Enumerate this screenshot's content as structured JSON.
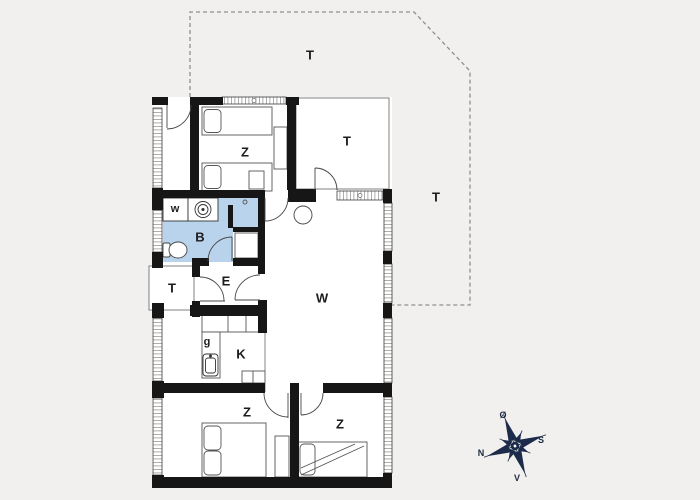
{
  "plan": {
    "rooms": {
      "terrace_top": "T",
      "terrace_right": "T",
      "terrace_room": "T",
      "terrace_left": "T",
      "bedroom_top": "Z",
      "bedroom_bottom_left": "Z",
      "bedroom_bottom_right": "Z",
      "living_room": "W",
      "bathroom": "B",
      "entry": "E",
      "kitchen": "K",
      "washing_machine": "w",
      "dishwasher": "g"
    },
    "colors": {
      "bathroom_fill": "#b9d3ec",
      "wall": "#161616",
      "dashed_outline": "#8f8f8f",
      "background": "#f1f0ee",
      "compass": "#1d2b4a"
    }
  },
  "compass": {
    "north": "N",
    "south": "S",
    "east": "Ø",
    "west": "V"
  }
}
